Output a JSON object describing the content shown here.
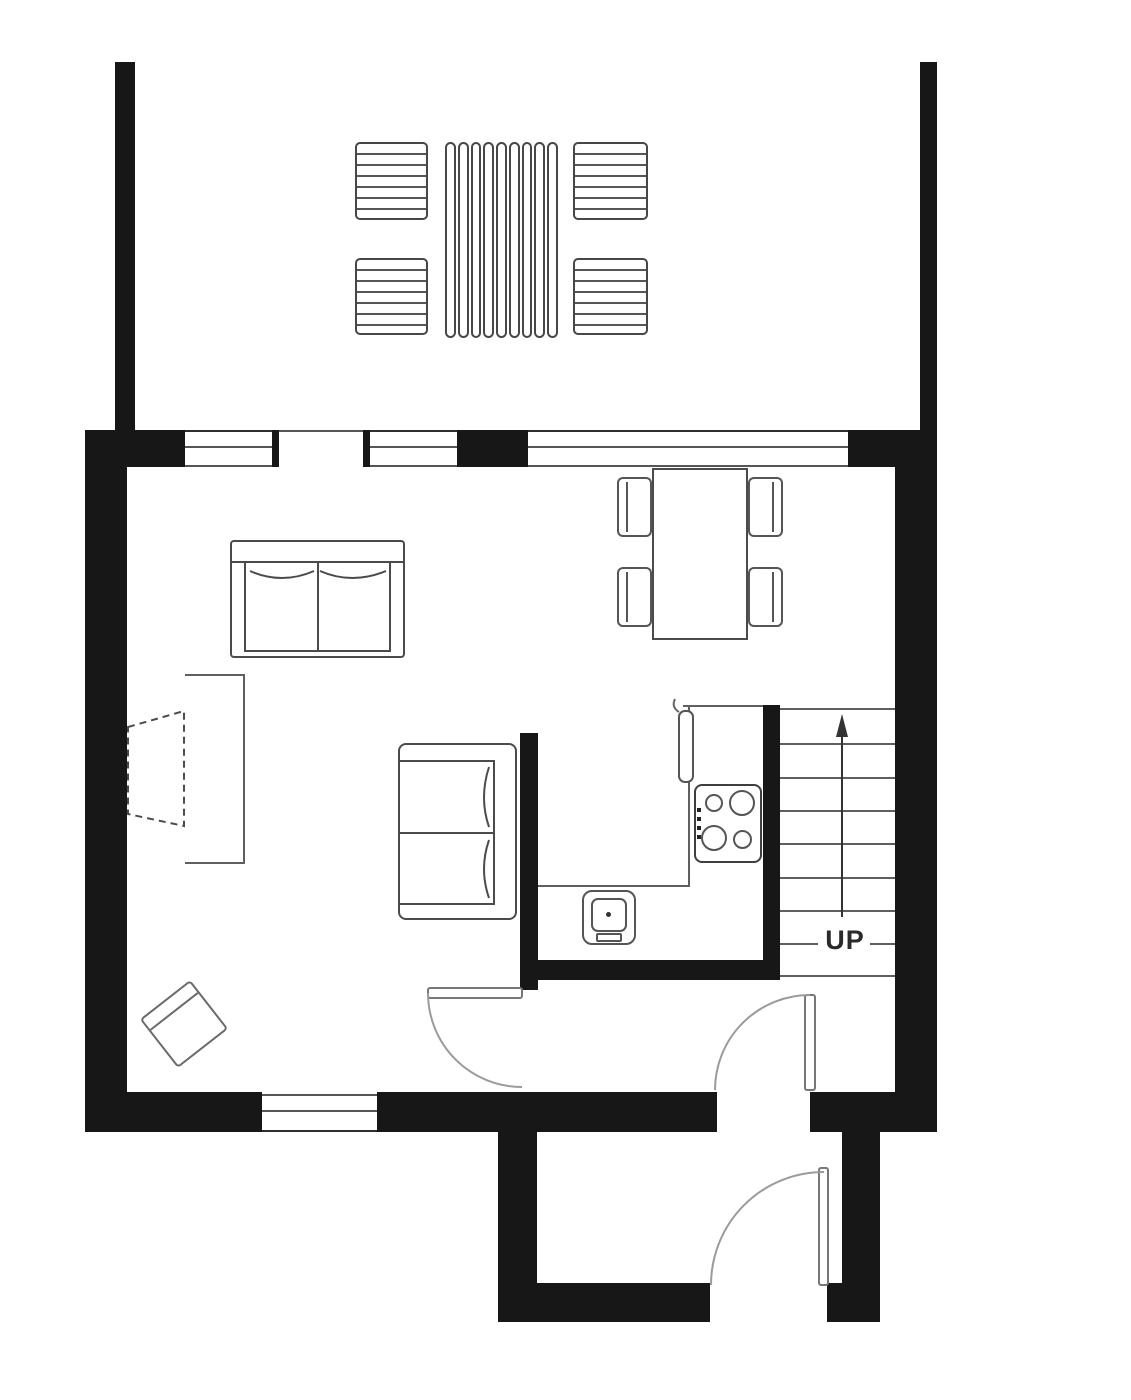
{
  "diagram": {
    "type": "residential floor plan - ground floor",
    "labels": {
      "stairs_direction": "UP"
    },
    "colors": {
      "wall": "#171717",
      "furniture_line": "#4b4b4b",
      "thin_line": "#5f5f5f",
      "door_arc": "#9b9b9b",
      "background": "#ffffff"
    },
    "symbols": [
      "deck",
      "patio-table",
      "patio-chair",
      "sofa",
      "loveseat",
      "fireplace",
      "dining-table",
      "dining-chair",
      "kitchen-counter",
      "stove",
      "sink",
      "stairs",
      "up-arrow",
      "interior-door",
      "front-door",
      "window"
    ]
  }
}
